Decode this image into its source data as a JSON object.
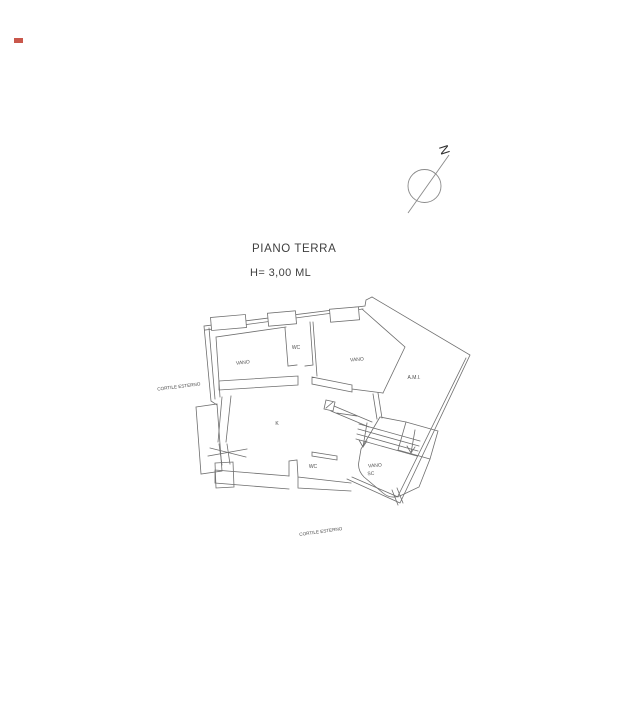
{
  "title_block": {
    "title": "PIANO TERRA",
    "height_note": "H= 3,00 ML"
  },
  "north": {
    "label": "N"
  },
  "plan": {
    "labels": {
      "vano_top_left": "VANO",
      "wc_top": "WC",
      "vano_top_right": "VANO",
      "ami_wing": "A.M.I.",
      "kitchen": "K",
      "wc_bottom": "WC",
      "stair_room_line1": "VANO",
      "stair_room_line2": "SC",
      "courtyard_left": "CORTILE ESTERNO",
      "courtyard_bottom": "CORTILE ESTERNO"
    }
  },
  "colors": {
    "wall_line": "#6e6e6e",
    "room_label": "#4f4f4f",
    "title_text": "#3c3c3c",
    "marker": "#c0392b"
  }
}
